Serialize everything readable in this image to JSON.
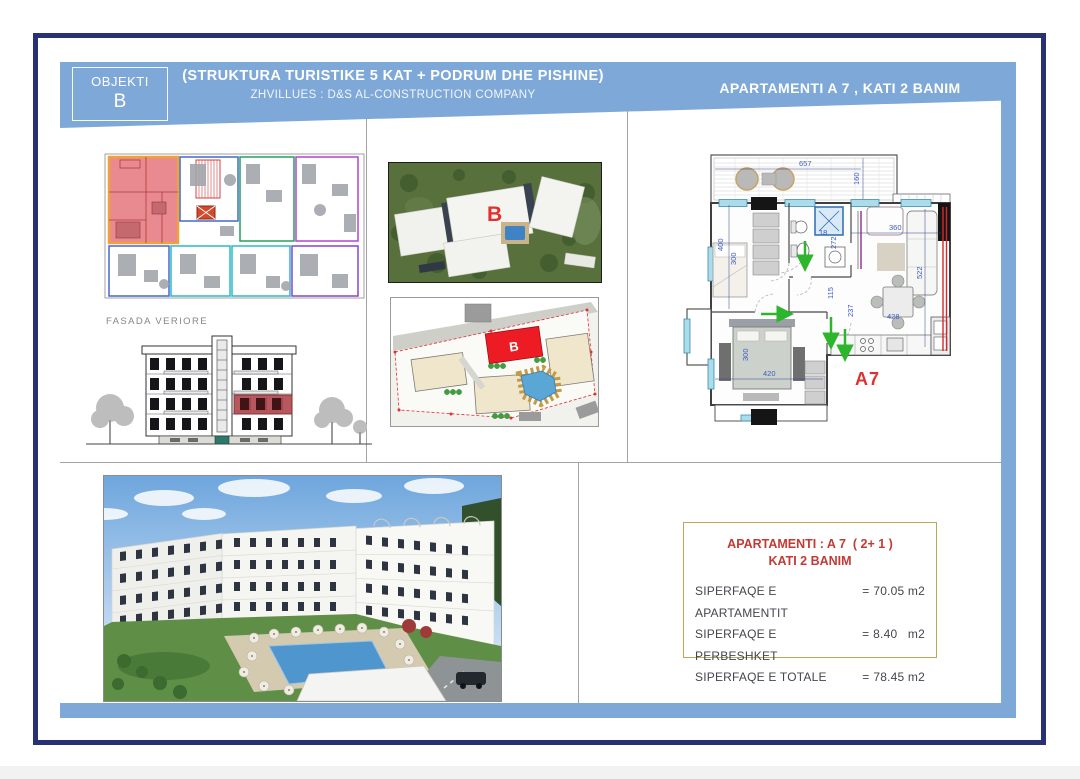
{
  "header": {
    "objekti_label": "OBJEKTI",
    "objekti_letter": "B",
    "title": "(STRUKTURA TURISTIKE 5 KAT + PODRUM DHE PISHINE)",
    "developer": "ZHVILLUES :  D&S AL-CONSTRUCTION COMPANY",
    "apartment_title": "APARTAMENTI A 7 ,  KATI 2 BANIM"
  },
  "left_column": {
    "facade_label": "FASADA VERIORE"
  },
  "aerial": {
    "building_label": "B"
  },
  "siteplan": {
    "building_label": "B"
  },
  "plan_a7": {
    "label": "A7",
    "dims": {
      "balcony_w": "657",
      "balcony_d": "160",
      "bed1_w": "400",
      "bed1_d": "300",
      "wc_w": "18",
      "wc_d": "272",
      "living_w": "360",
      "living_d": "522",
      "hall_w": "115",
      "hall_d": "237",
      "dining_w": "428",
      "bed2_w": "420",
      "bed2_d": "300"
    }
  },
  "info_box": {
    "title_line1": "APARTAMENTI : A 7  ( 2+ 1 )",
    "title_line2": "KATI 2 BANIM",
    "rows": [
      {
        "label": "SIPERFAQE E APARTAMENTIT",
        "eq": "=",
        "value": "70.05 m2"
      },
      {
        "label": "SIPERFAQE E PERBESHKET",
        "eq": "=",
        "value": "8.40   m2"
      },
      {
        "label": "SIPERFAQE E TOTALE",
        "eq": "=",
        "value": "78.45 m2"
      }
    ]
  },
  "colors": {
    "frame_navy": "#283173",
    "band_blue": "#7ea8d8",
    "accent_red": "#e0312e",
    "info_border_olive": "#bfa75a",
    "dim_blue": "#3a5bc7"
  }
}
